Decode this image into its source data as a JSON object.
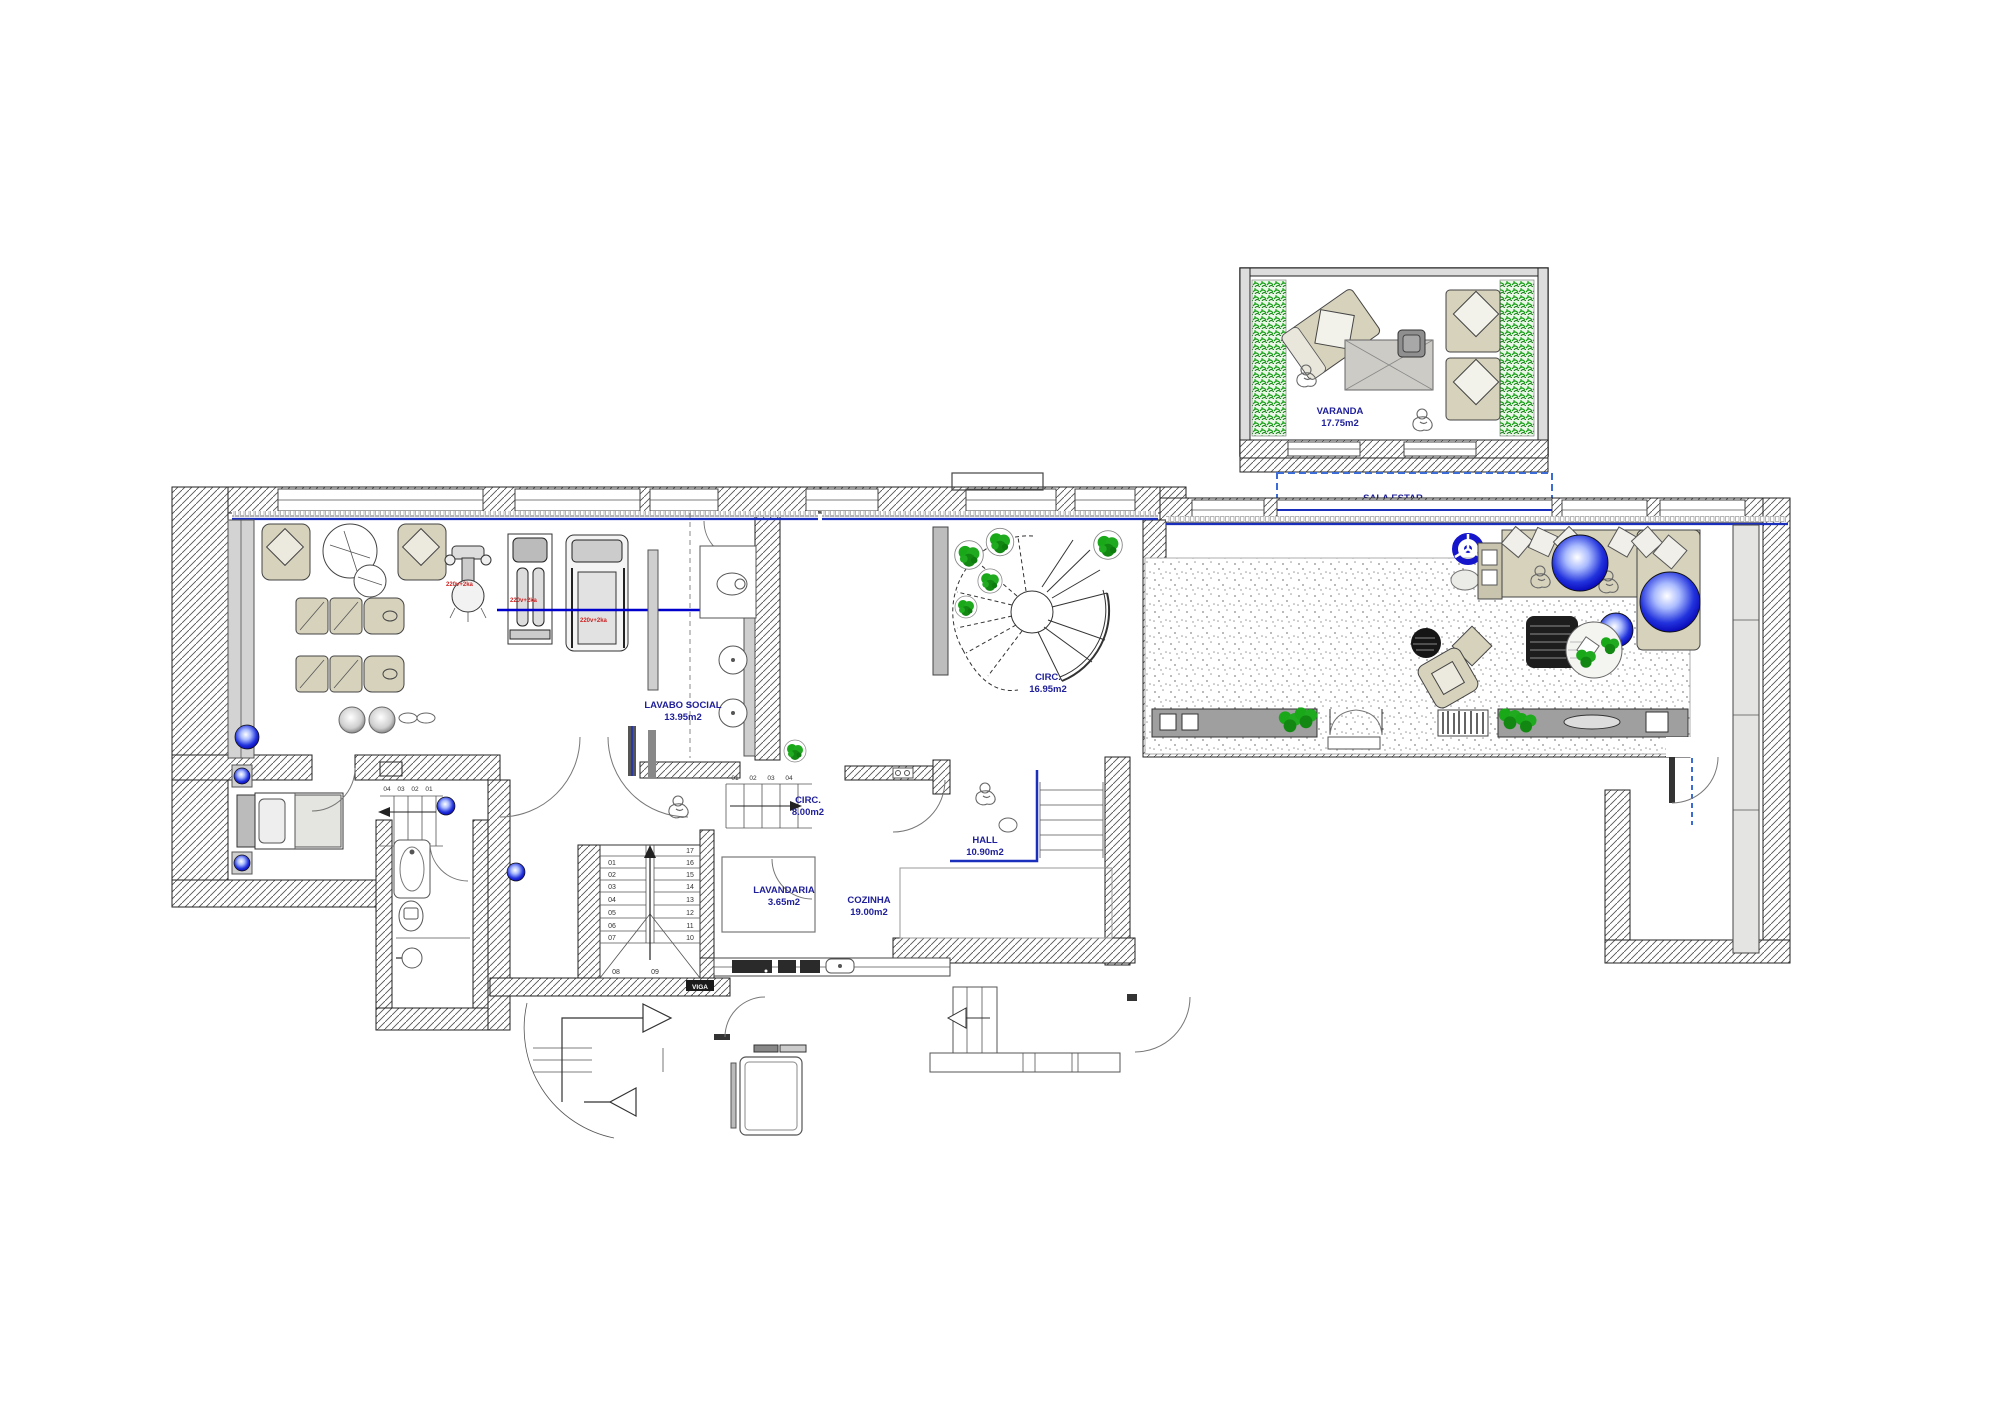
{
  "rooms": {
    "varanda": {
      "name": "VARANDA",
      "area": "17.75m2"
    },
    "sala_estar": {
      "name": "SALA ESTAR",
      "area": "72.85m2"
    },
    "circ_stair": {
      "name": "CIRC.",
      "area": "16.95m2"
    },
    "lavabo_social": {
      "name": "LAVABO SOCIAL",
      "area": "13.95m2"
    },
    "circ_hall": {
      "name": "CIRC.",
      "area": "8.00m2"
    },
    "hall": {
      "name": "HALL",
      "area": "10.90m2"
    },
    "lavandaria": {
      "name": "LAVANDARIA",
      "area": "3.65m2"
    },
    "cozinha": {
      "name": "COZINHA",
      "area": "19.00m2"
    }
  },
  "stairs": {
    "main": {
      "treads": [
        "01",
        "02",
        "03",
        "04",
        "05",
        "06",
        "07",
        "08",
        "09",
        "10",
        "11",
        "12",
        "13",
        "14",
        "15",
        "16",
        "17"
      ]
    },
    "corridor": {
      "treads": [
        "01",
        "02",
        "03",
        "04"
      ]
    },
    "bedroom": {
      "treads": [
        "04",
        "03",
        "02",
        "01"
      ]
    }
  },
  "annotations": {
    "electrical": [
      "220v+2ka",
      "220v+2ka",
      "220v+2ka"
    ],
    "beam_tag": "VIGA"
  },
  "colors": {
    "label_navy": "#20209a",
    "accent_blue": "#1b2fbd",
    "sphere_blue": "#2233ee",
    "plant_green": "#1faa1f",
    "electrical_red": "#cc2222",
    "furniture_beige": "#d6d2bc",
    "console_gray": "#9f9f9f"
  }
}
